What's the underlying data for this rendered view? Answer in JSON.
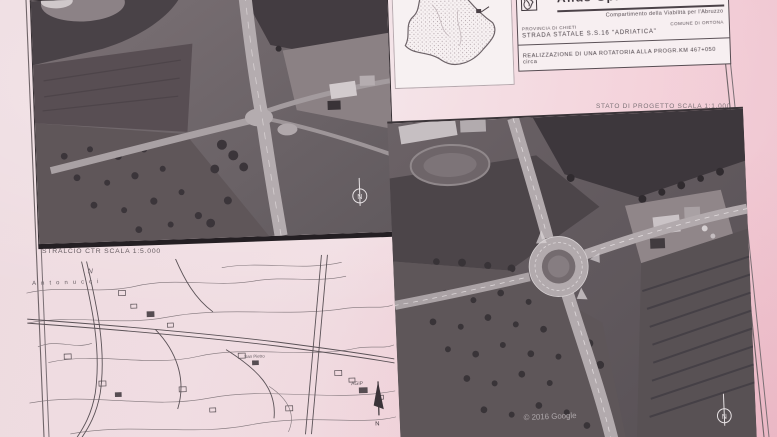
{
  "sheet": {
    "title_block": {
      "company": "Anas SpA",
      "department": "Compartimento della Viabilità per l'Abruzzo",
      "province": "PROVINCIA DI CHIETI",
      "municipality": "COMUNE DI ORTONA",
      "road": "STRADA STATALE S.S.16 \"ADRIATICA\"",
      "project_title": "REALIZZAZIONE DI UNA ROTATORIA ALLA PROGR.KM 467+050 circa"
    },
    "captions": {
      "project_state": "STATO DI PROGETTO SCALA 1:1.000",
      "ctr_excerpt": "STRALCIO CTR SCALA 1:5.000"
    },
    "watermark": "© 2016 Google",
    "north_label": "N",
    "ctr_labels": {
      "antonucci": "Antonucci",
      "north_letter": "N",
      "san_pietro": "San Pietro",
      "agip": "AGIP"
    },
    "colors": {
      "paper_pink": "#f1dee3",
      "paper_pink_deep": "#f0c6d1",
      "photo_dark": "#433c41",
      "photo_mid": "#6e6468",
      "road_light": "#b3abae",
      "ink": "#4a4046"
    }
  }
}
